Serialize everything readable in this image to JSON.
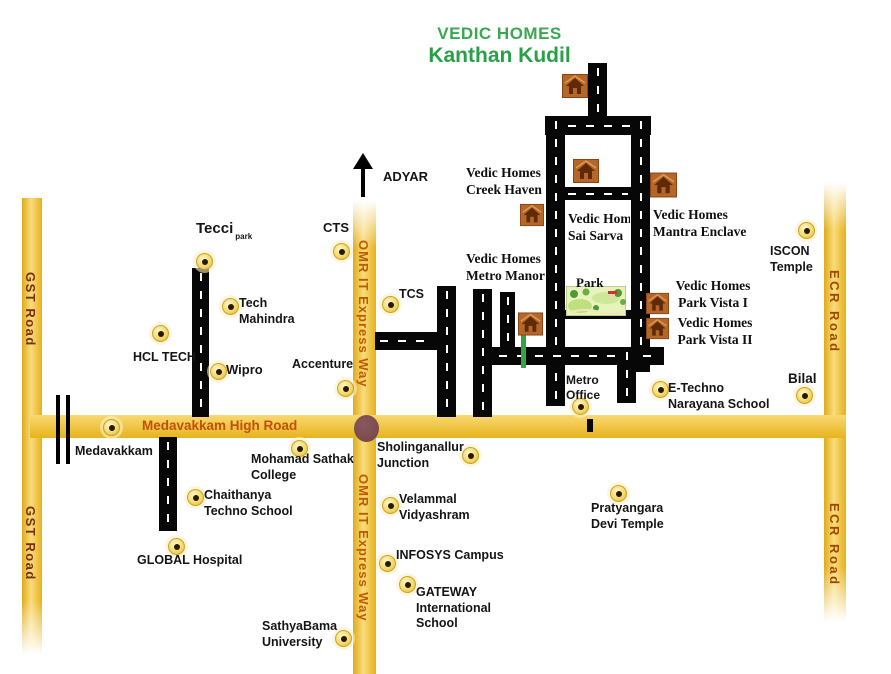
{
  "title": {
    "line1": "VEDIC HOMES",
    "line2": "Kanthan Kudil"
  },
  "roads": {
    "gst": "GST Road",
    "omr": "OMR IT Express Way",
    "ecr": "ECR Road",
    "high": "Medavakkam High Road"
  },
  "direction": {
    "adyar": "ADYAR"
  },
  "labels": {
    "tecci": "Tecci",
    "tecci_sub": "park",
    "cts": "CTS",
    "tech_mahindra": [
      "Tech",
      "Mahindra"
    ],
    "hcl_tech": "HCL TECH",
    "wipro": "Wipro",
    "accenture": "Accenture",
    "tcs": "TCS",
    "creek_haven": [
      "Vedic Homes",
      "Creek Haven"
    ],
    "sai_sarva": [
      "Vedic Homes",
      "Sai Sarva"
    ],
    "mantra_enclave": [
      "Vedic Homes",
      "Mantra Enclave"
    ],
    "metro_manor": [
      "Vedic Homes",
      "Metro Manor"
    ],
    "park": "Park",
    "park_vista_1": [
      "Vedic Homes",
      "Park Vista I"
    ],
    "park_vista_2": [
      "Vedic Homes",
      "Park Vista II"
    ],
    "iscon_temple": [
      "ISCON",
      "Temple"
    ],
    "metro_office": [
      "Metro",
      "Office"
    ],
    "e_techno": [
      "E-Techno",
      "Narayana School"
    ],
    "bilal": "Bilal",
    "medavakkam": "Medavakkam",
    "mohamad_sathak": [
      "Mohamad Sathak",
      "College"
    ],
    "sholinganallur": [
      "Sholinganallur",
      "Junction"
    ],
    "chaithanya": [
      "Chaithanya",
      "Techno School"
    ],
    "global_hospital": "GLOBAL Hospital",
    "velammal": [
      "Velammal",
      "Vidyashram"
    ],
    "infosys": "INFOSYS Campus",
    "gateway": [
      "GATEWAY",
      "International",
      "School"
    ],
    "sathyabama": [
      "SathyaBama",
      "University"
    ],
    "pratyangara": [
      "Pratyangara",
      "Devi Temple"
    ]
  },
  "icons": {
    "house": "house-icon",
    "marker": "location-dot-icon",
    "north_arrow": "up-arrow-icon",
    "junction": "junction-circle",
    "railway": "railway-crossing",
    "park": "park-illustration"
  },
  "colors": {
    "band_yellow": "#f5c424",
    "road_black": "#070707",
    "title_green": "#3aa850",
    "title_green2": "#27a148",
    "gst_text": "#7b2d10",
    "omr_text": "#c05a00",
    "ecr_text": "#9c4a00",
    "high_road_text": "#c3500a",
    "junction_brown": "#7a4a4e",
    "green_line": "#3aa048",
    "house_orange": "#b5672a",
    "marker_gold": "#e4ba34"
  }
}
